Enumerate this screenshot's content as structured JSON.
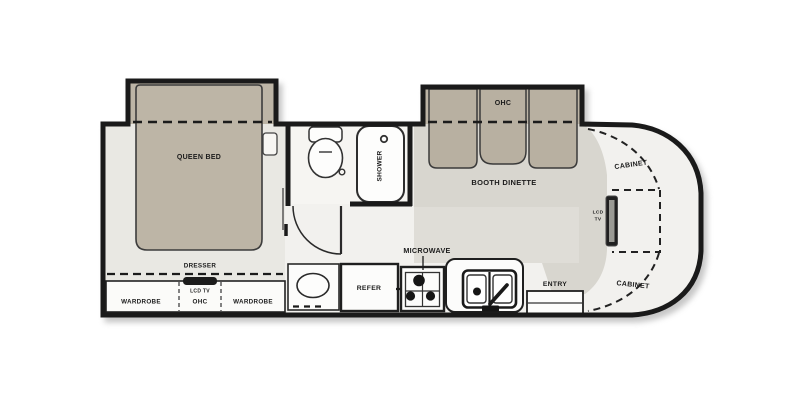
{
  "floorplan": {
    "bedroom": {
      "ohc_label": "OHC",
      "bed_label": "QUEEN BED",
      "dresser_label": "DRESSER",
      "wardrobe_left_label": "WARDROBE",
      "tv_ohc_label_line1": "LCD TV",
      "tv_ohc_label_line2": "OHC",
      "wardrobe_right_label": "WARDROBE"
    },
    "bathroom": {
      "shower_label": "SHOWER"
    },
    "dinette": {
      "ohc_label": "OHC",
      "label": "BOOTH DINETTE"
    },
    "galley": {
      "microwave_label": "MICROWAVE",
      "refer_label": "REFER",
      "entry_label": "ENTRY"
    },
    "rear": {
      "cabinet_top_label": "CABINET",
      "cabinet_bottom_label": "CABINET",
      "tv_label_line1": "LCD",
      "tv_label_line2": "TV"
    },
    "colors": {
      "cabinetry_tan": "#bdb5a6",
      "bench_tan": "#b8b0a1",
      "walkway_gray": "#d8d6cf",
      "walkway_gray_light": "#dfddd7",
      "bedroom_floor": "#e9e8e3",
      "bathroom_floor": "#f6f5f2",
      "interior_floor": "#f2f1ee",
      "wall_black": "#1a1a1a"
    }
  }
}
